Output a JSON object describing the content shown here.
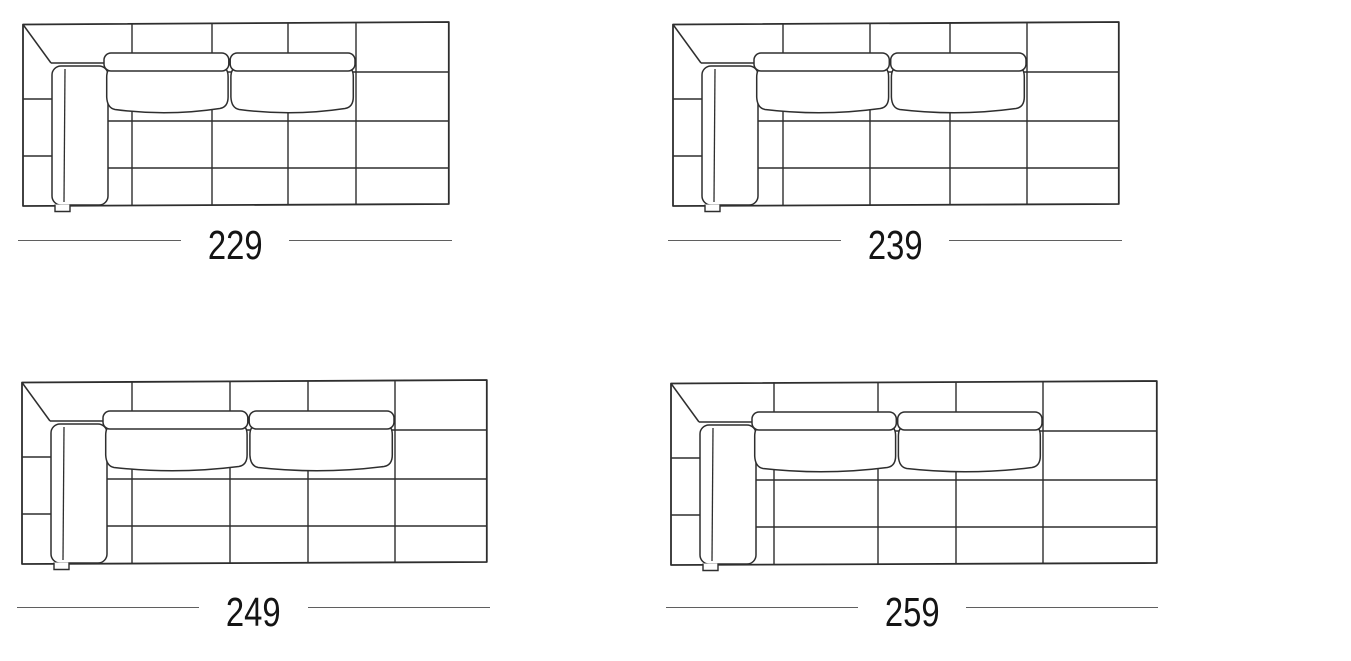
{
  "style": {
    "background": "#ffffff",
    "line_color": "#2e2e2e",
    "dimension_line_color": "#5f5f5f",
    "text_color": "#141414"
  },
  "schematic": {
    "description": "top-view sofa schematic with left armrest, two seat cushions and quilted grid",
    "diag_x": 29,
    "diag_y": 42,
    "armrest": {
      "x": 30,
      "y": 45,
      "w": 56,
      "h": 139,
      "rx": 9,
      "inner_x": 43
    },
    "tab": {
      "x1": 33,
      "x2": 48,
      "y": 190.5
    },
    "cushion": {
      "x0": 82,
      "top": 32,
      "band_h": 18,
      "rx": 7
    }
  },
  "diagrams": [
    {
      "id": "sofa-229",
      "label": "229",
      "width_cm": 229,
      "frame": {
        "x": 22,
        "y": 21,
        "w": 428,
        "h": 186
      },
      "grid": {
        "verticals": [
          110,
          190,
          266,
          334
        ],
        "horizontals": [
          51,
          100,
          147
        ],
        "left_strip": [
          78,
          135
        ]
      },
      "dimension": {
        "x": 18,
        "y": 240,
        "w": 434
      }
    },
    {
      "id": "sofa-239",
      "label": "239",
      "width_cm": 239,
      "frame": {
        "x": 672,
        "y": 21,
        "w": 448,
        "h": 186
      },
      "grid": {
        "verticals": [
          111,
          198,
          278,
          355
        ],
        "horizontals": [
          51,
          100,
          147
        ],
        "left_strip": [
          78,
          135
        ]
      },
      "dimension": {
        "x": 668,
        "y": 240,
        "w": 454
      }
    },
    {
      "id": "sofa-249",
      "label": "249",
      "width_cm": 249,
      "frame": {
        "x": 21,
        "y": 379,
        "w": 467,
        "h": 186
      },
      "grid": {
        "verticals": [
          111,
          209,
          287,
          374
        ],
        "horizontals": [
          51,
          100,
          147
        ],
        "left_strip": [
          78,
          135
        ]
      },
      "dimension": {
        "x": 17,
        "y": 607,
        "w": 473
      }
    },
    {
      "id": "sofa-259",
      "label": "259",
      "width_cm": 259,
      "frame": {
        "x": 670,
        "y": 380,
        "w": 488,
        "h": 186
      },
      "grid": {
        "verticals": [
          104,
          208,
          286,
          373
        ],
        "horizontals": [
          51,
          100,
          147
        ],
        "left_strip": [
          78,
          135
        ]
      },
      "dimension": {
        "x": 666,
        "y": 607,
        "w": 492
      }
    }
  ]
}
